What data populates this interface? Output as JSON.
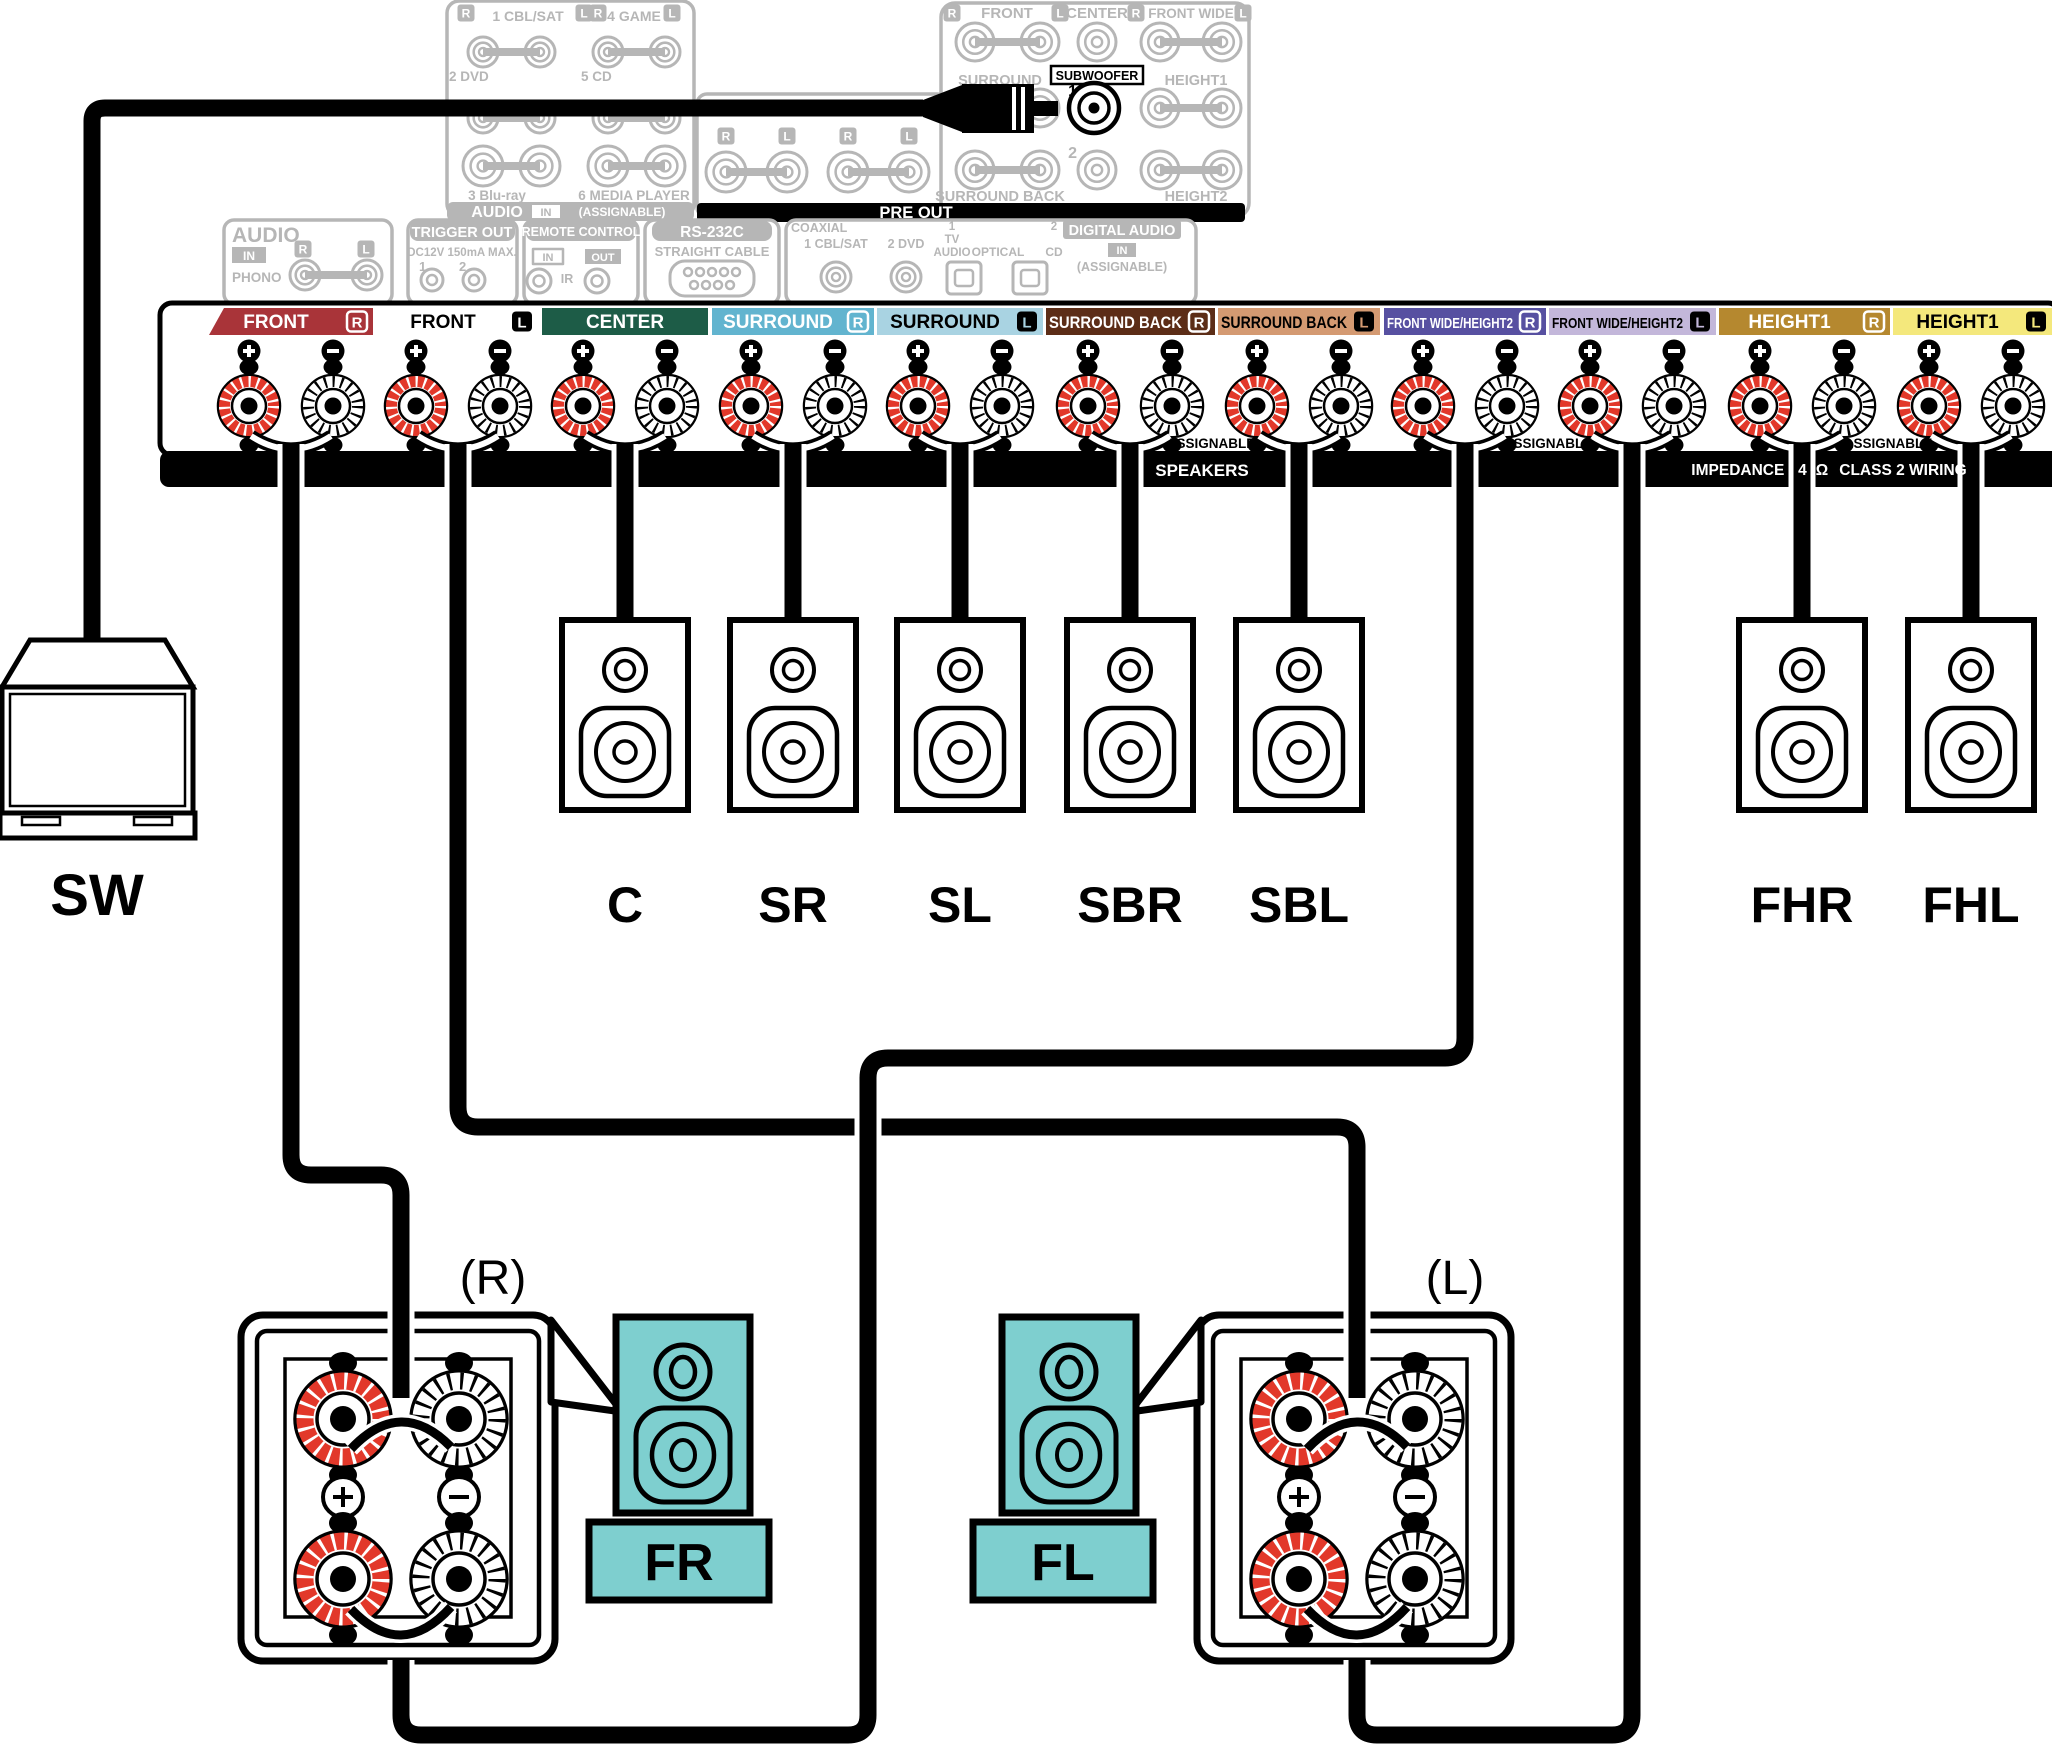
{
  "colors": {
    "teal": "#7ecfcf",
    "post_red": "#e2382a",
    "panel_gray": "#b6b6b6",
    "black": "#000000"
  },
  "rear_panel": {
    "audio_inputs": {
      "row1": [
        {
          "l": "R",
          "text": "1 CBL/SAT",
          "r": "L"
        },
        {
          "l": "R",
          "text": "4 GAME",
          "r": "L"
        }
      ],
      "row2": [
        "2 DVD",
        "5 CD"
      ],
      "row3": [
        "3 Blu-ray",
        "6 MEDIA PLAYER"
      ],
      "bar": {
        "title": "AUDIO",
        "badge": "IN",
        "note": "(ASSIGNABLE)"
      }
    },
    "channel_markers": [
      "R",
      "L",
      "R",
      "L"
    ],
    "pre_out": {
      "row1_front": {
        "l": "R",
        "text": "FRONT",
        "r": "L"
      },
      "row1_center": "CENTER",
      "row1_wide": {
        "l": "R",
        "text": "FRONT WIDE",
        "r": "L"
      },
      "row2": [
        "SURROUND",
        "HEIGHT1"
      ],
      "row3": [
        "SURROUND BACK",
        "HEIGHT2"
      ],
      "sub_jack1": "1",
      "sub_jack2": "2",
      "bar": "PRE OUT"
    },
    "subwoofer_out": {
      "label": "SUBWOOFER"
    },
    "audio_io": {
      "title": "AUDIO",
      "badge": "IN",
      "ch_l": "R",
      "ch_r": "L",
      "jack_label": "PHONO"
    },
    "trigger_out": {
      "title": "TRIGGER OUT",
      "sub": "DC12V 150mA MAX.",
      "j1": "1",
      "j2": "2"
    },
    "remote_control": {
      "title": "REMOTE CONTROL",
      "badge_in": "IN",
      "badge_out": "OUT",
      "jack_label": "IR"
    },
    "rs232c": {
      "title": "RS-232C",
      "sub": "STRAIGHT CABLE"
    },
    "digital_audio": {
      "coaxial_label": "COAXIAL",
      "coax1": "1 CBL/SAT",
      "coax2": "2 DVD",
      "opt1_num": "1",
      "opt1_a": "TV",
      "opt1_b": "AUDIO",
      "optical_label": "OPTICAL",
      "opt2_num": "2",
      "opt2_name": "CD",
      "title": "DIGITAL AUDIO",
      "badge": "IN",
      "note": "(ASSIGNABLE)"
    }
  },
  "speaker_terminals": {
    "labels": [
      {
        "text": "FRONT",
        "ch": "R",
        "bg": "#a93439",
        "fg": "#ffffff"
      },
      {
        "text": "FRONT",
        "ch": "L",
        "bg": "#ffffff",
        "fg": "#000000"
      },
      {
        "text": "CENTER",
        "ch": "",
        "bg": "#1d5c47",
        "fg": "#ffffff"
      },
      {
        "text": "SURROUND",
        "ch": "R",
        "bg": "#62b4cf",
        "fg": "#ffffff"
      },
      {
        "text": "SURROUND",
        "ch": "L",
        "bg": "#a9d3e2",
        "fg": "#000000"
      },
      {
        "text": "SURROUND BACK",
        "ch": "R",
        "bg": "#5c2d17",
        "fg": "#ffffff"
      },
      {
        "text": "SURROUND BACK",
        "ch": "L",
        "bg": "#d49a72",
        "fg": "#000000"
      },
      {
        "text": "FRONT WIDE/HEIGHT2",
        "ch": "R",
        "bg": "#5750a1",
        "fg": "#ffffff"
      },
      {
        "text": "FRONT WIDE/HEIGHT2",
        "ch": "L",
        "bg": "#c3b7da",
        "fg": "#000000"
      },
      {
        "text": "HEIGHT1",
        "ch": "R",
        "bg": "#b5882f",
        "fg": "#ffffff"
      },
      {
        "text": "HEIGHT1",
        "ch": "L",
        "bg": "#f4e87c",
        "fg": "#000000"
      }
    ],
    "plus": "+",
    "minus": "−",
    "assignable": "ASSIGNABLE",
    "bar": {
      "speakers": "SPEAKERS",
      "impedance": "IMPEDANCE : 4",
      "ohm": "Ω",
      "class2": "CLASS 2 WIRING"
    }
  },
  "speakers": {
    "sw": "SW",
    "row": [
      "C",
      "SR",
      "SL",
      "SBR",
      "SBL"
    ],
    "heights": [
      "FHR",
      "FHL"
    ],
    "front_right": "FR",
    "front_left": "FL",
    "right_mark": "(R)",
    "left_mark": "(L)"
  }
}
